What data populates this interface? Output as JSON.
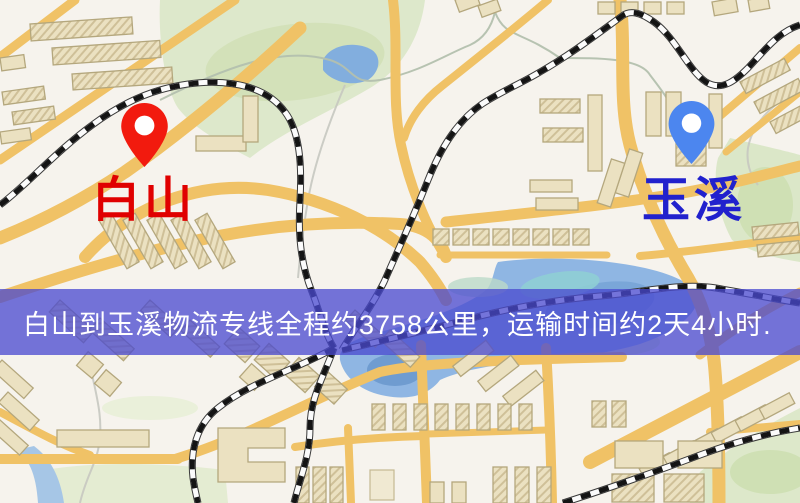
{
  "page": {
    "type": "logistics-route-map"
  },
  "banner": {
    "text": "白山到玉溪物流专线全程约3758公里，运输时间约2天4小时.",
    "background_color": "#4949d0",
    "text_color": "#ffffff"
  },
  "origin": {
    "label": "白山",
    "label_color": "#e00000",
    "pin_color": "#f21a0e",
    "pin_icon": "map-pin"
  },
  "destination": {
    "label": "玉溪",
    "label_color": "#2121cd",
    "pin_color": "#4c86ef",
    "pin_icon": "map-pin"
  },
  "route": {
    "distance_km": 3758,
    "distance_text": "约3758公里",
    "duration_text": "约2天4小时"
  },
  "map_colors": {
    "background": "#f6f3ed",
    "road": "#f0c266",
    "water": "#8fb6e3",
    "park": "#dce8ca",
    "building": "#ebe1c1",
    "railway": "#141414"
  }
}
